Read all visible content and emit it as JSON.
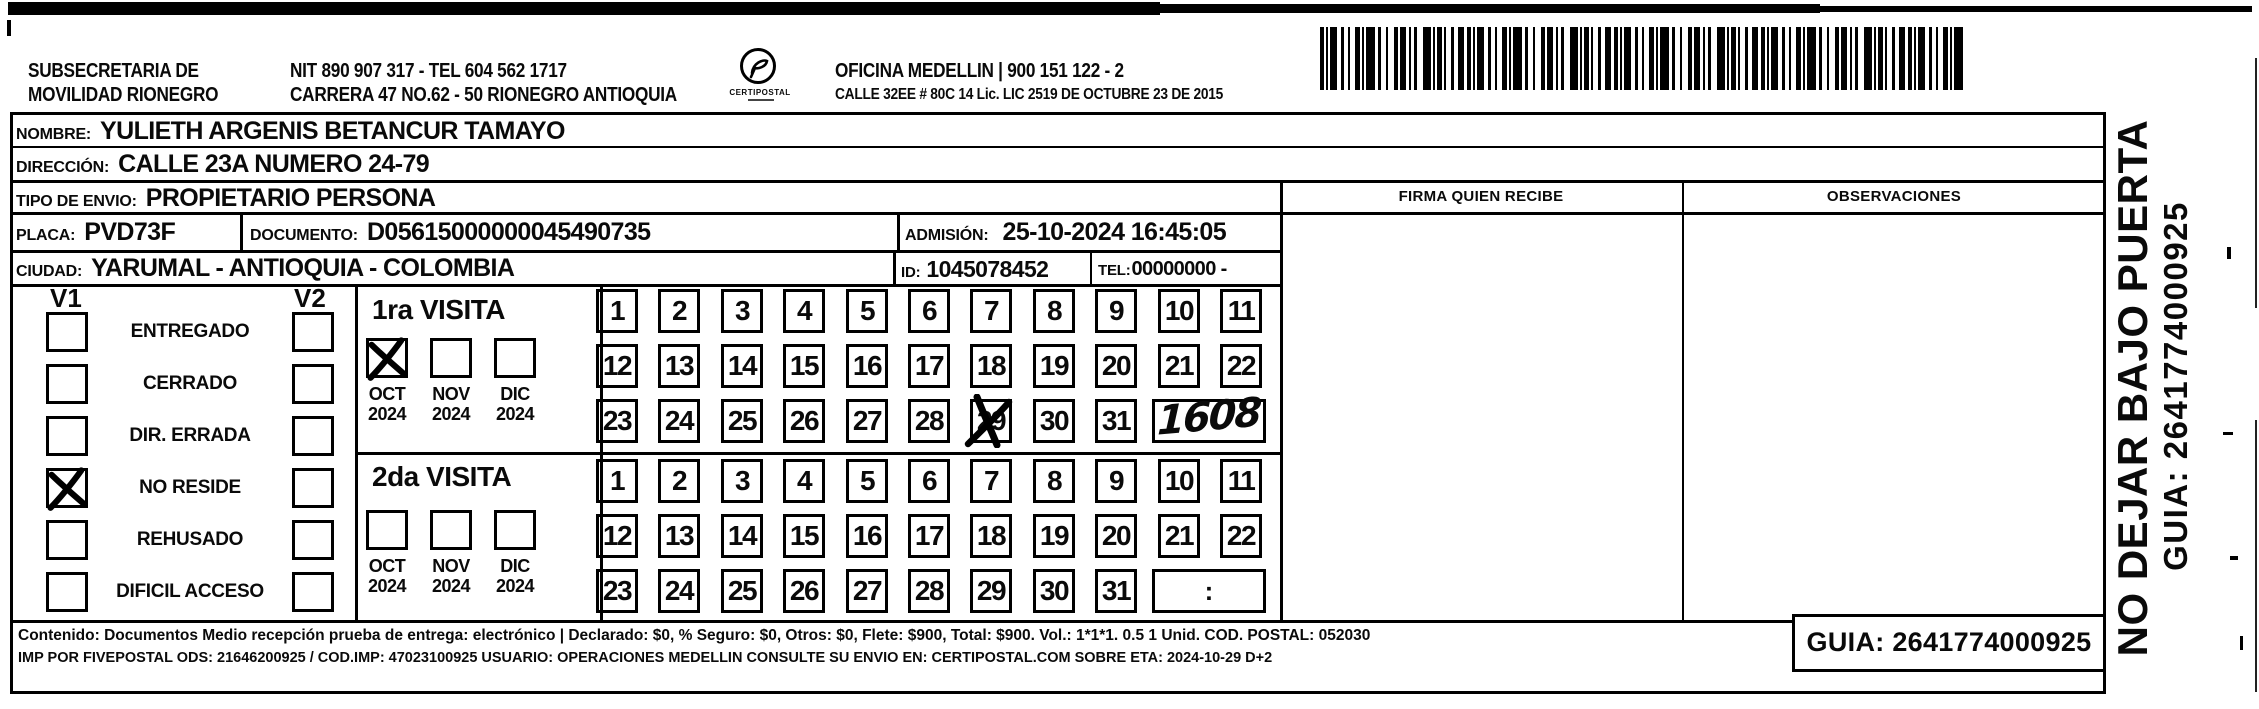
{
  "header": {
    "org_line1": "SUBSECRETARIA  DE",
    "org_line2": "MOVILIDAD RIONEGRO",
    "nit_line": "NIT 890 907 317 - TEL 604 562 1717",
    "address_line": "CARRERA 47 NO.62 - 50 RIONEGRO ANTIOQUIA",
    "logo_text": "CERTIPOSTAL",
    "office_line": "OFICINA MEDELLIN | 900 151 122 - 2",
    "license_line": "CALLE 32EE # 80C 14 Lic. LIC 2519 DE OCTUBRE 23 DE 2015"
  },
  "shipment": {
    "nombre": {
      "label": "NOMBRE:",
      "value": "YULIETH ARGENIS BETANCUR TAMAYO"
    },
    "direccion": {
      "label": "DIRECCIÓN:",
      "value": "CALLE 23A NUMERO 24-79"
    },
    "tipo_envio": {
      "label": "TIPO DE ENVIO:",
      "value": "PROPIETARIO PERSONA"
    },
    "placa": {
      "label": "PLACA:",
      "value": "PVD73F"
    },
    "documento": {
      "label": "DOCUMENTO:",
      "value": "D05615000000045490735"
    },
    "admision": {
      "label": "ADMISIÓN:",
      "value": "25-10-2024 16:45:05"
    },
    "ciudad": {
      "label": "CIUDAD:",
      "value": "YARUMAL - ANTIOQUIA - COLOMBIA"
    },
    "id": {
      "label": "ID:",
      "value": "1045078452"
    },
    "tel": {
      "label": "TEL:",
      "value": "00000000 -"
    }
  },
  "status_panel": {
    "v1_header": "V1",
    "v2_header": "V2",
    "items": [
      {
        "label": "ENTREGADO",
        "v1": false,
        "v2": false
      },
      {
        "label": "CERRADO",
        "v1": false,
        "v2": false
      },
      {
        "label": "DIR. ERRADA",
        "v1": false,
        "v2": false
      },
      {
        "label": "NO RESIDE",
        "v1": true,
        "v2": false
      },
      {
        "label": "REHUSADO",
        "v1": false,
        "v2": false
      },
      {
        "label": "DIFICIL ACCESO",
        "v1": false,
        "v2": false
      }
    ]
  },
  "visits": [
    {
      "title": "1ra VISITA",
      "months": [
        {
          "month": "OCT",
          "year": "2024",
          "checked": true
        },
        {
          "month": "NOV",
          "year": "2024",
          "checked": false
        },
        {
          "month": "DIC",
          "year": "2024",
          "checked": false
        }
      ],
      "day_count": 31,
      "crossed_day": 29,
      "time_box": "1608",
      "handwritten": true
    },
    {
      "title": "2da VISITA",
      "months": [
        {
          "month": "OCT",
          "year": "2024",
          "checked": false
        },
        {
          "month": "NOV",
          "year": "2024",
          "checked": false
        },
        {
          "month": "DIC",
          "year": "2024",
          "checked": false
        }
      ],
      "day_count": 31,
      "crossed_day": null,
      "time_box": ":",
      "handwritten": false
    }
  ],
  "right_panel": {
    "firma_header": "FIRMA QUIEN RECIBE",
    "observaciones_header": "OBSERVACIONES"
  },
  "side_text": {
    "warning": "NO DEJAR BAJO PUERTA",
    "guia": "GUIA: 2641774000925"
  },
  "footer": {
    "line1": "Contenido: Documentos Medio recepción prueba de entrega: electrónico | Declarado: $0, % Seguro: $0, Otros: $0, Flete: $900, Total: $900. Vol.: 1*1*1. 0.5  1 Unid. COD. POSTAL: 052030",
    "line2": "IMP POR FIVEPOSTAL ODS: 21646200925 / COD.IMP: 47023100925 USUARIO: OPERACIONES MEDELLIN CONSULTE SU ENVIO EN: CERTIPOSTAL.COM SOBRE ETA: 2024-10-29 D+2",
    "guia": "GUIA: 2641774000925"
  },
  "barcode": {
    "name": "shipment-barcode"
  }
}
